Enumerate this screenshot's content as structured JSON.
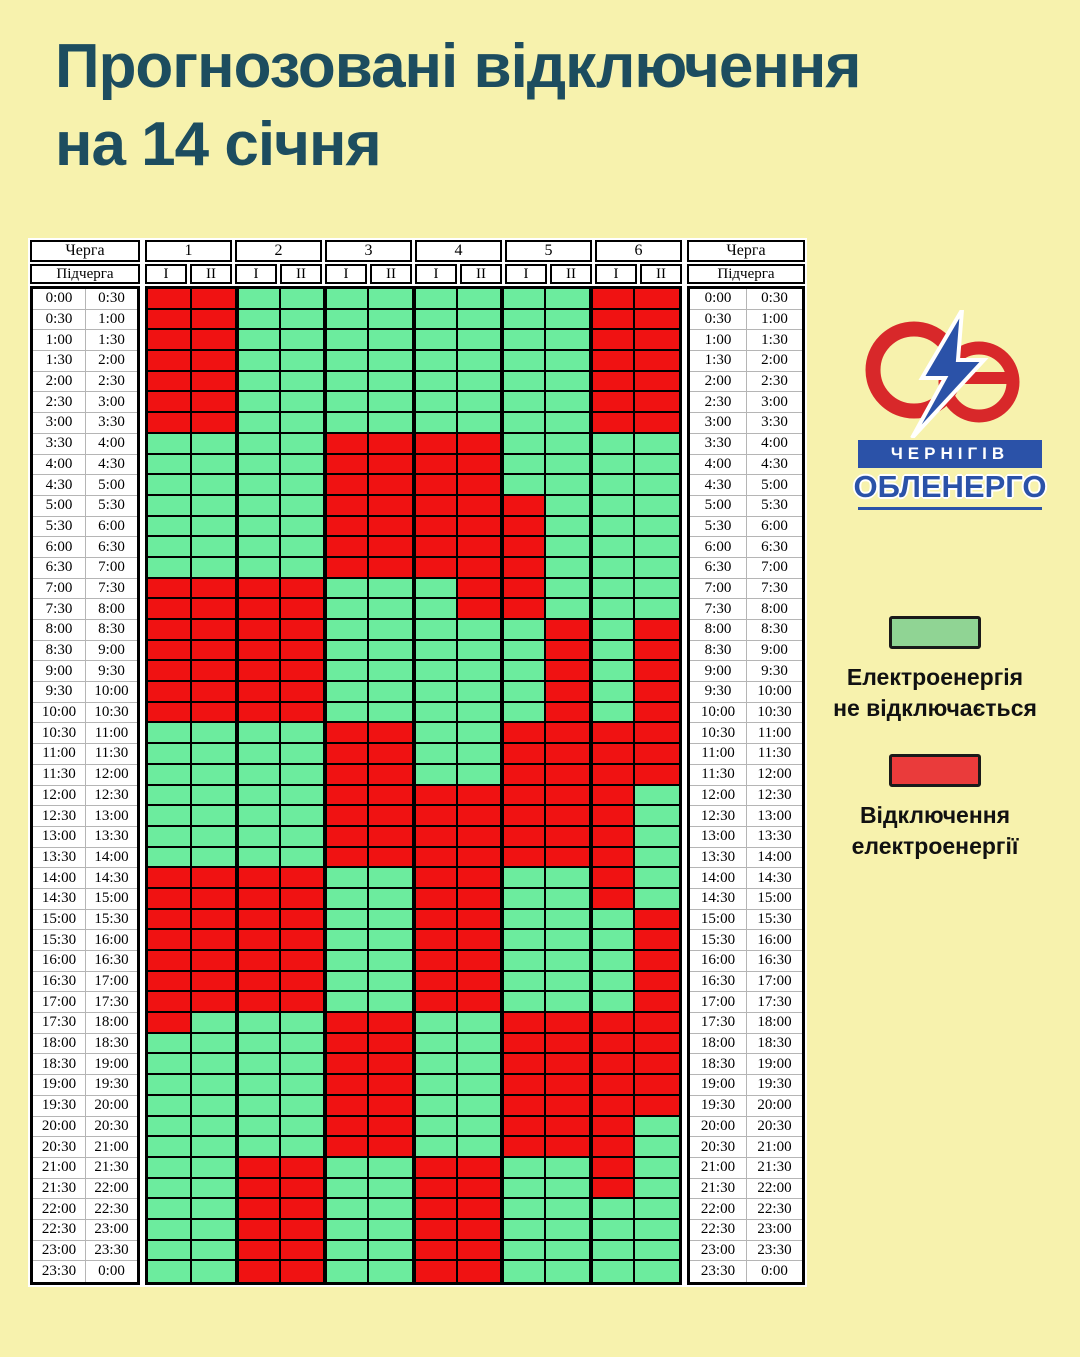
{
  "page": {
    "background": "#f7f2ad"
  },
  "title": {
    "line1": "Прогнозовані відключення",
    "line2": "на 14 січня",
    "color": "#1d4d5f"
  },
  "logo": {
    "mark": "Oe-lightning",
    "city": "ЧЕРНІГІВ",
    "company": "ОБЛЕНЕРГО",
    "red": "#d8282a",
    "blue": "#2b52a8"
  },
  "legend": {
    "on": {
      "label_line1": "Електроенергія",
      "label_line2": "не відключається",
      "swatch_color": "#90d494"
    },
    "off": {
      "label_line1": "Відключення",
      "label_line2": "електроенергії",
      "swatch_color": "#ea3b3b"
    }
  },
  "table": {
    "corner_row1": "Черга",
    "corner_row2": "Підчерга",
    "queues": [
      "1",
      "2",
      "3",
      "4",
      "5",
      "6"
    ],
    "subqueues": [
      "I",
      "II"
    ]
  },
  "chart_data": {
    "type": "heatmap",
    "title": "Прогнозовані відключення на 14 січня",
    "columns": [
      "1-I",
      "1-II",
      "2-I",
      "2-II",
      "3-I",
      "3-II",
      "4-I",
      "4-II",
      "5-I",
      "5-II",
      "6-I",
      "6-II"
    ],
    "cell_legend": {
      "G": "Електроенергія не відключається",
      "R": "Відключення електроенергії"
    },
    "cell_colors": {
      "G": "#6cec9e",
      "R": "#f01212"
    },
    "rows": [
      {
        "start": "0:00",
        "end": "0:30",
        "cells": "RRGGGGGGGGRR"
      },
      {
        "start": "0:30",
        "end": "1:00",
        "cells": "RRGGGGGGGGRR"
      },
      {
        "start": "1:00",
        "end": "1:30",
        "cells": "RRGGGGGGGGRR"
      },
      {
        "start": "1:30",
        "end": "2:00",
        "cells": "RRGGGGGGGGRR"
      },
      {
        "start": "2:00",
        "end": "2:30",
        "cells": "RRGGGGGGGGRR"
      },
      {
        "start": "2:30",
        "end": "3:00",
        "cells": "RRGGGGGGGGRR"
      },
      {
        "start": "3:00",
        "end": "3:30",
        "cells": "RRGGGGGGGGRR"
      },
      {
        "start": "3:30",
        "end": "4:00",
        "cells": "GGGGRRRRGGGG"
      },
      {
        "start": "4:00",
        "end": "4:30",
        "cells": "GGGGRRRRGGGG"
      },
      {
        "start": "4:30",
        "end": "5:00",
        "cells": "GGGGRRRRGGGG"
      },
      {
        "start": "5:00",
        "end": "5:30",
        "cells": "GGGGRRRRRGGG"
      },
      {
        "start": "5:30",
        "end": "6:00",
        "cells": "GGGGRRRRRGGG"
      },
      {
        "start": "6:00",
        "end": "6:30",
        "cells": "GGGGRRRRRGGG"
      },
      {
        "start": "6:30",
        "end": "7:00",
        "cells": "GGGGRRRRRGGG"
      },
      {
        "start": "7:00",
        "end": "7:30",
        "cells": "RRRRGGGRRGGG"
      },
      {
        "start": "7:30",
        "end": "8:00",
        "cells": "RRRRGGGRRGGG"
      },
      {
        "start": "8:00",
        "end": "8:30",
        "cells": "RRRRGGGGGRGR"
      },
      {
        "start": "8:30",
        "end": "9:00",
        "cells": "RRRRGGGGGRGR"
      },
      {
        "start": "9:00",
        "end": "9:30",
        "cells": "RRRRGGGGGRGR"
      },
      {
        "start": "9:30",
        "end": "10:00",
        "cells": "RRRRGGGGGRGR"
      },
      {
        "start": "10:00",
        "end": "10:30",
        "cells": "RRRRGGGGGRGR"
      },
      {
        "start": "10:30",
        "end": "11:00",
        "cells": "GGGGRRGGRRRR"
      },
      {
        "start": "11:00",
        "end": "11:30",
        "cells": "GGGGRRGGRRRR"
      },
      {
        "start": "11:30",
        "end": "12:00",
        "cells": "GGGGRRGGRRRR"
      },
      {
        "start": "12:00",
        "end": "12:30",
        "cells": "GGGGRRRRRRRG"
      },
      {
        "start": "12:30",
        "end": "13:00",
        "cells": "GGGGRRRRRRRG"
      },
      {
        "start": "13:00",
        "end": "13:30",
        "cells": "GGGGRRRRRRRG"
      },
      {
        "start": "13:30",
        "end": "14:00",
        "cells": "GGGGRRRRRRRG"
      },
      {
        "start": "14:00",
        "end": "14:30",
        "cells": "RRRRGGRRGGRG"
      },
      {
        "start": "14:30",
        "end": "15:00",
        "cells": "RRRRGGRRGGRG"
      },
      {
        "start": "15:00",
        "end": "15:30",
        "cells": "RRRRGGRRGGGR"
      },
      {
        "start": "15:30",
        "end": "16:00",
        "cells": "RRRRGGRRGGGR"
      },
      {
        "start": "16:00",
        "end": "16:30",
        "cells": "RRRRGGRRGGGR"
      },
      {
        "start": "16:30",
        "end": "17:00",
        "cells": "RRRRGGRRGGGR"
      },
      {
        "start": "17:00",
        "end": "17:30",
        "cells": "RRRRGGRRGGGR"
      },
      {
        "start": "17:30",
        "end": "18:00",
        "cells": "RGGGRRGGRRRR"
      },
      {
        "start": "18:00",
        "end": "18:30",
        "cells": "GGGGRRGGRRRR"
      },
      {
        "start": "18:30",
        "end": "19:00",
        "cells": "GGGGRRGGRRRR"
      },
      {
        "start": "19:00",
        "end": "19:30",
        "cells": "GGGGRRGGRRRR"
      },
      {
        "start": "19:30",
        "end": "20:00",
        "cells": "GGGGRRGGRRRR"
      },
      {
        "start": "20:00",
        "end": "20:30",
        "cells": "GGGGRRGGRRRG"
      },
      {
        "start": "20:30",
        "end": "21:00",
        "cells": "GGGGRRGGRRRG"
      },
      {
        "start": "21:00",
        "end": "21:30",
        "cells": "GGRRGGRRGGRG"
      },
      {
        "start": "21:30",
        "end": "22:00",
        "cells": "GGRRGGRRGGRG"
      },
      {
        "start": "22:00",
        "end": "22:30",
        "cells": "GGRRGGRRGGGG"
      },
      {
        "start": "22:30",
        "end": "23:00",
        "cells": "GGRRGGRRGGGG"
      },
      {
        "start": "23:00",
        "end": "23:30",
        "cells": "GGRRGGRRGGGG"
      },
      {
        "start": "23:30",
        "end": "0:00",
        "cells": "GGRRGGRRGGGG"
      }
    ]
  }
}
